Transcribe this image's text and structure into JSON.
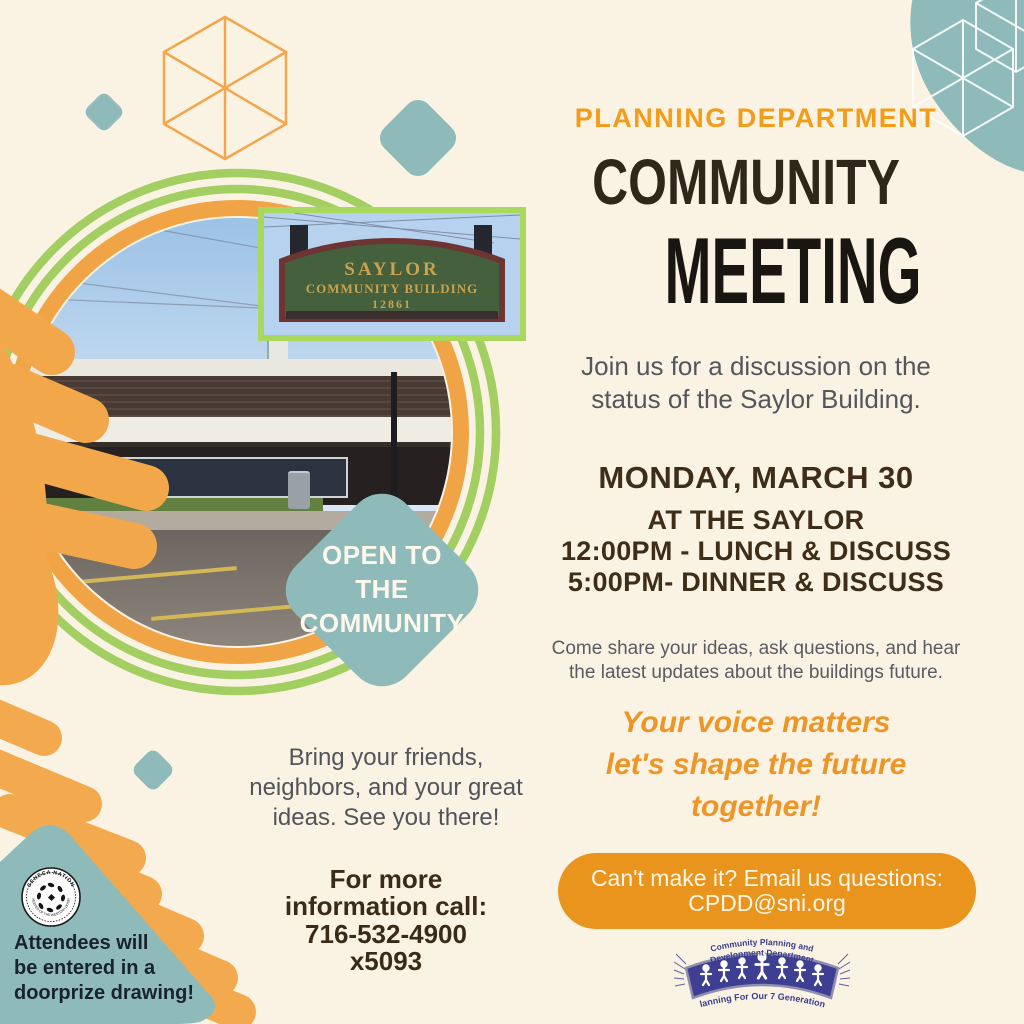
{
  "header": {
    "eyebrow": "PLANNING DEPARTMENT",
    "title_line1": "COMMUNITY",
    "title_line2": "MEETING"
  },
  "intro": {
    "lines": [
      "Join us for a discussion on the",
      "status of the Saylor Building."
    ]
  },
  "schedule": {
    "date": "MONDAY, MARCH 30",
    "lines": [
      "AT THE SAYLOR",
      "12:00PM - LUNCH & DISCUSS",
      "5:00PM- DINNER & DISCUSS"
    ]
  },
  "share": {
    "lines": [
      "Come share your ideas, ask questions, and hear",
      "the latest updates about the buildings future."
    ]
  },
  "voice": {
    "lines": [
      "Your voice matters",
      "let's shape the future",
      "together!"
    ]
  },
  "email_cta": {
    "line1": "Can't make it? Email us questions:",
    "line2": "CPDD@sni.org"
  },
  "open_badge": {
    "lines": [
      "OPEN TO",
      "THE",
      "COMMUNITY"
    ]
  },
  "bring": {
    "lines": [
      "Bring your friends,",
      "neighbors, and your great",
      "ideas. See you there!"
    ]
  },
  "info": {
    "lines": [
      "For more",
      "information call:",
      "716-532-4900",
      "x5093"
    ]
  },
  "doorprize": {
    "lines": [
      "Attendees will",
      "be entered in a",
      "doorprize drawing!"
    ]
  },
  "sign": {
    "line1": "SAYLOR",
    "line2": "COMMUNITY BUILDING",
    "line3": "12861"
  },
  "seal": {
    "top": "SENECA NATION",
    "bottom": "KEEPER OF THE WESTERN DOOR"
  },
  "dept_logo": {
    "arc_line1": "Community Planning and",
    "arc_line2": "Development Department",
    "tagline": "Planning For Our 7 Generations"
  },
  "colors": {
    "background": "#faf3e3",
    "accent_orange": "#f09d2b",
    "pill_orange": "#e9941d",
    "teal": "#8fbaba",
    "green": "#a2ce62",
    "title_dark": "#191611",
    "brown_dark": "#3e2d18",
    "text_gray": "#55565b",
    "logo_blue": "#3a3c8c",
    "sign_green": "#44603c",
    "sign_gold": "#c9a250"
  }
}
